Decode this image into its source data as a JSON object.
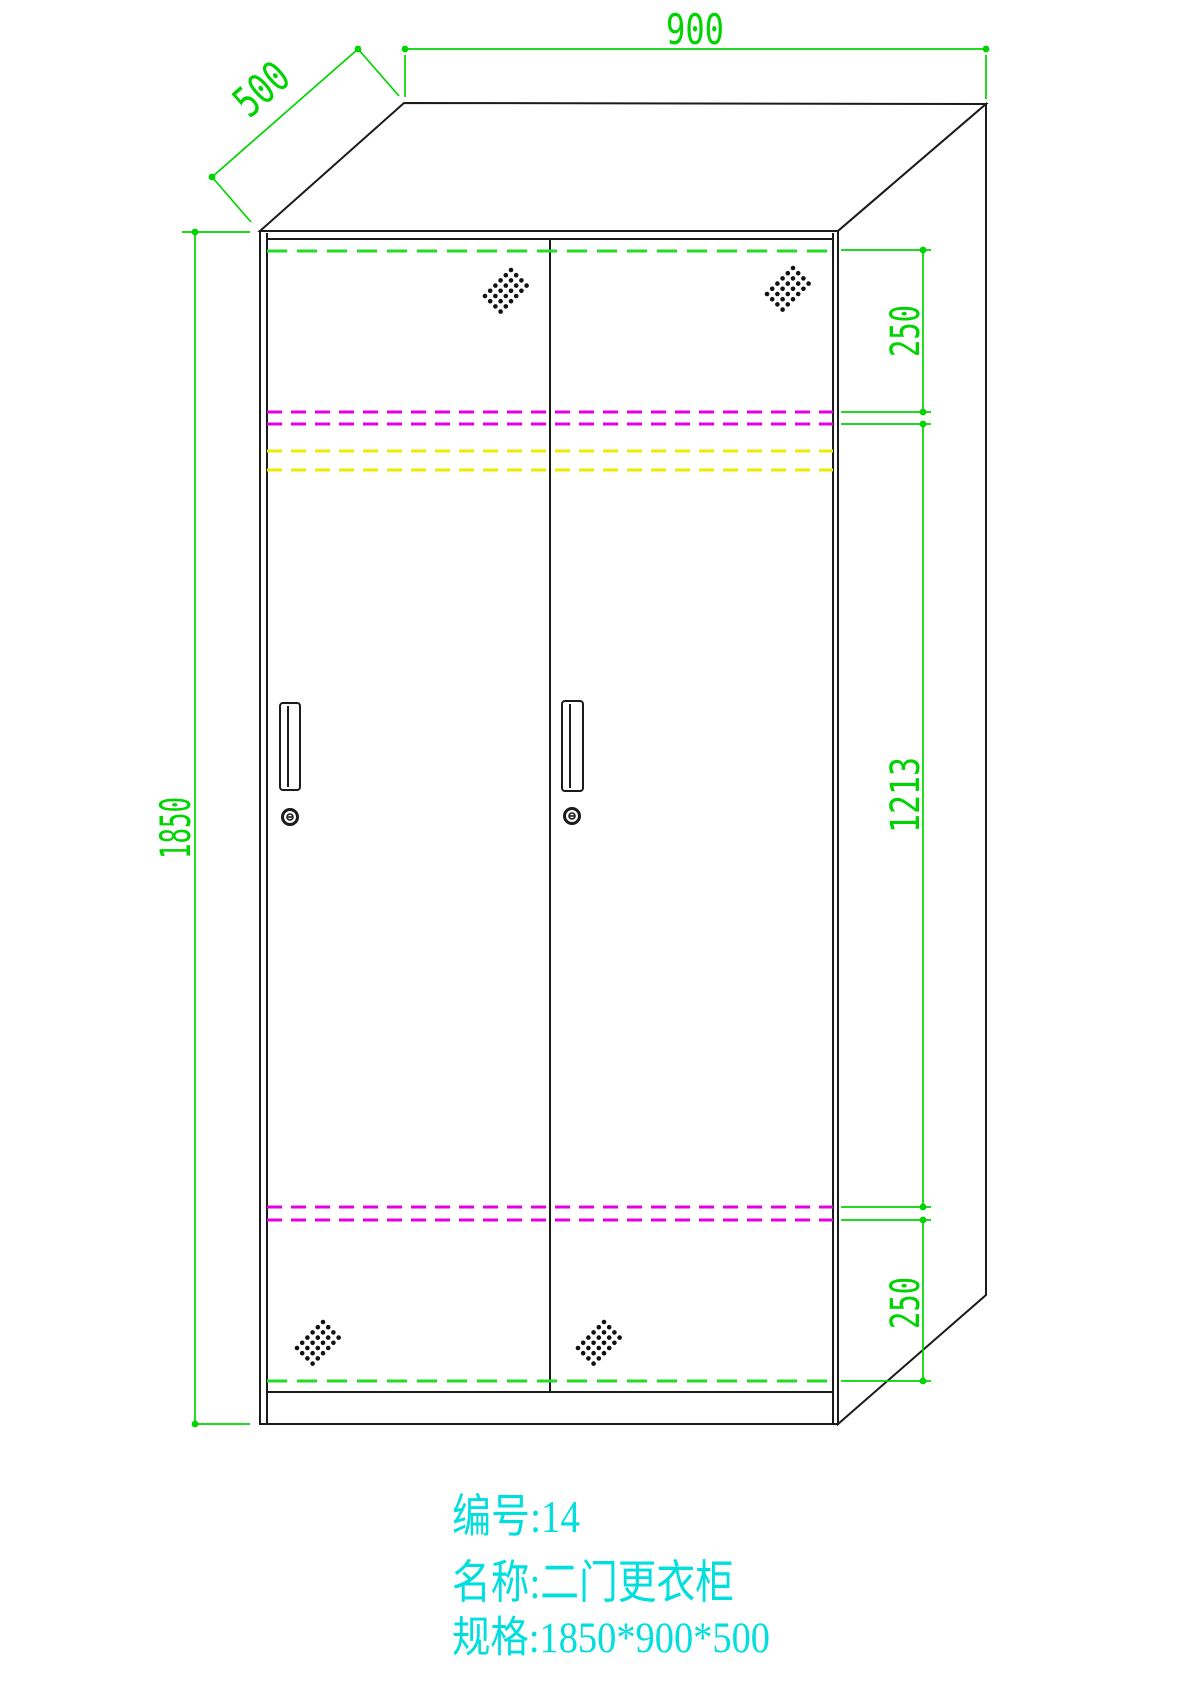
{
  "drawing_title": "二门更衣柜 technical drawing",
  "dimension_labels": {
    "width": "900",
    "depth": "500",
    "height": "1850",
    "right_top": "250",
    "right_middle": "1213",
    "right_bottom": "250"
  },
  "info_block": {
    "number": "编号:14",
    "name": "名称:二门更衣柜",
    "spec": "规格:1850*900*500"
  },
  "colors": {
    "outline": "#1b1b1b",
    "dimension": "#00d400",
    "dashed_green": "#22dd22",
    "dashed_magenta": "#e400e4",
    "dashed_yellow": "#ebeb00",
    "vent_dot": "#111111",
    "label_text": "#00dede",
    "background": "#ffffff"
  }
}
